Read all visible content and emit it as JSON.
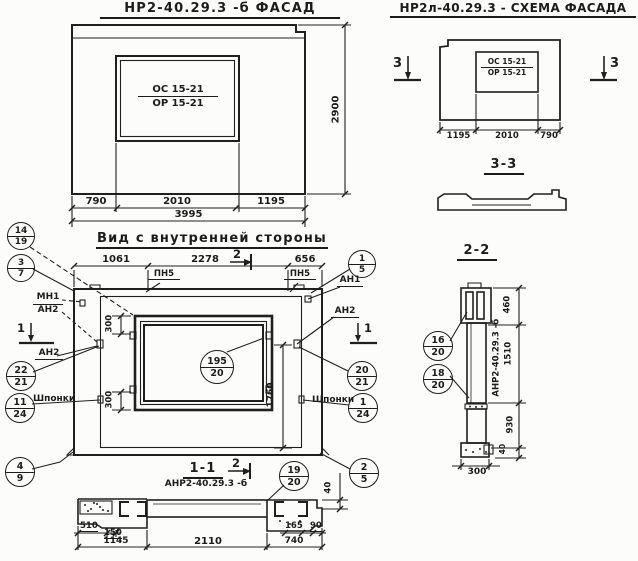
{
  "doc": {
    "title_facade": "НР2-40.29.3 -б  ФАСАД",
    "title_scheme": "НР2л-40.29.3 - СХЕМА ФАСАДА",
    "title_inner_view": "Вид с внутренней стороны",
    "section_33_title": "3-3",
    "section_22_title": "2-2",
    "section_11_title": "1-1",
    "label_anr_11": "АНР2-40.29.3 -б",
    "label_anr_22": "АНР2-40.29.3 -б"
  },
  "facade": {
    "opening_mark_num": "ОС 15-21",
    "opening_mark_den": "ОР 15-21",
    "dim_left": "790",
    "dim_mid": "2010",
    "dim_right": "1195",
    "dim_total": "3995",
    "dim_height": "2900"
  },
  "scheme": {
    "opening_mark_num": "ОС 15-21",
    "opening_mark_den": "ОР 15-21",
    "dim_left": "1195",
    "dim_mid": "2010",
    "dim_right": "790",
    "marker_left": "3",
    "marker_right": "3"
  },
  "inner_view": {
    "dim_top_left": "1061",
    "dim_top_mid": "2278",
    "dim_top_right": "656",
    "marker_top": "2",
    "marker_bottom": "2",
    "marker_left": "1",
    "marker_right": "1",
    "label_pn5_left": "ПН5",
    "label_pn5_right": "ПН5",
    "label_mn1": "МН1",
    "label_mn1_den": "АН2",
    "label_an2_left": "АН2",
    "label_an1_right": "АН1",
    "label_an2_right": "АН2",
    "label_shponki_left": "Шпонки",
    "label_shponki_right": "Шпонки",
    "dim_300_top": "300",
    "dim_300_bottom": "300",
    "dim_1760": "1760",
    "dim_40": "40"
  },
  "section_22": {
    "dim_460": "460",
    "dim_1510": "1510",
    "dim_930": "930",
    "dim_40": "40",
    "dim_300": "300"
  },
  "section_11": {
    "dim_510": "510",
    "dim_150": "150",
    "dim_1145": "1145",
    "dim_2110": "2110",
    "dim_740": "740",
    "dim_165": "165",
    "dim_90": "90"
  },
  "callouts": {
    "c14_19": {
      "top": "14",
      "bottom": "19"
    },
    "c3_7": {
      "top": "3",
      "bottom": "7"
    },
    "c22_21": {
      "top": "22",
      "bottom": "21"
    },
    "c11_24": {
      "top": "11",
      "bottom": "24"
    },
    "c4_9": {
      "top": "4",
      "bottom": "9"
    },
    "c1_5": {
      "top": "1",
      "bottom": "5"
    },
    "c20_21": {
      "top": "20",
      "bottom": "21"
    },
    "c1_24": {
      "top": "1",
      "bottom": "24"
    },
    "c2_5": {
      "top": "2",
      "bottom": "5"
    },
    "c195_20": {
      "top": "195",
      "bottom": "20"
    },
    "c16_20": {
      "top": "16",
      "bottom": "20"
    },
    "c18_20": {
      "top": "18",
      "bottom": "20"
    },
    "c19_20": {
      "top": "19",
      "bottom": "20"
    }
  }
}
